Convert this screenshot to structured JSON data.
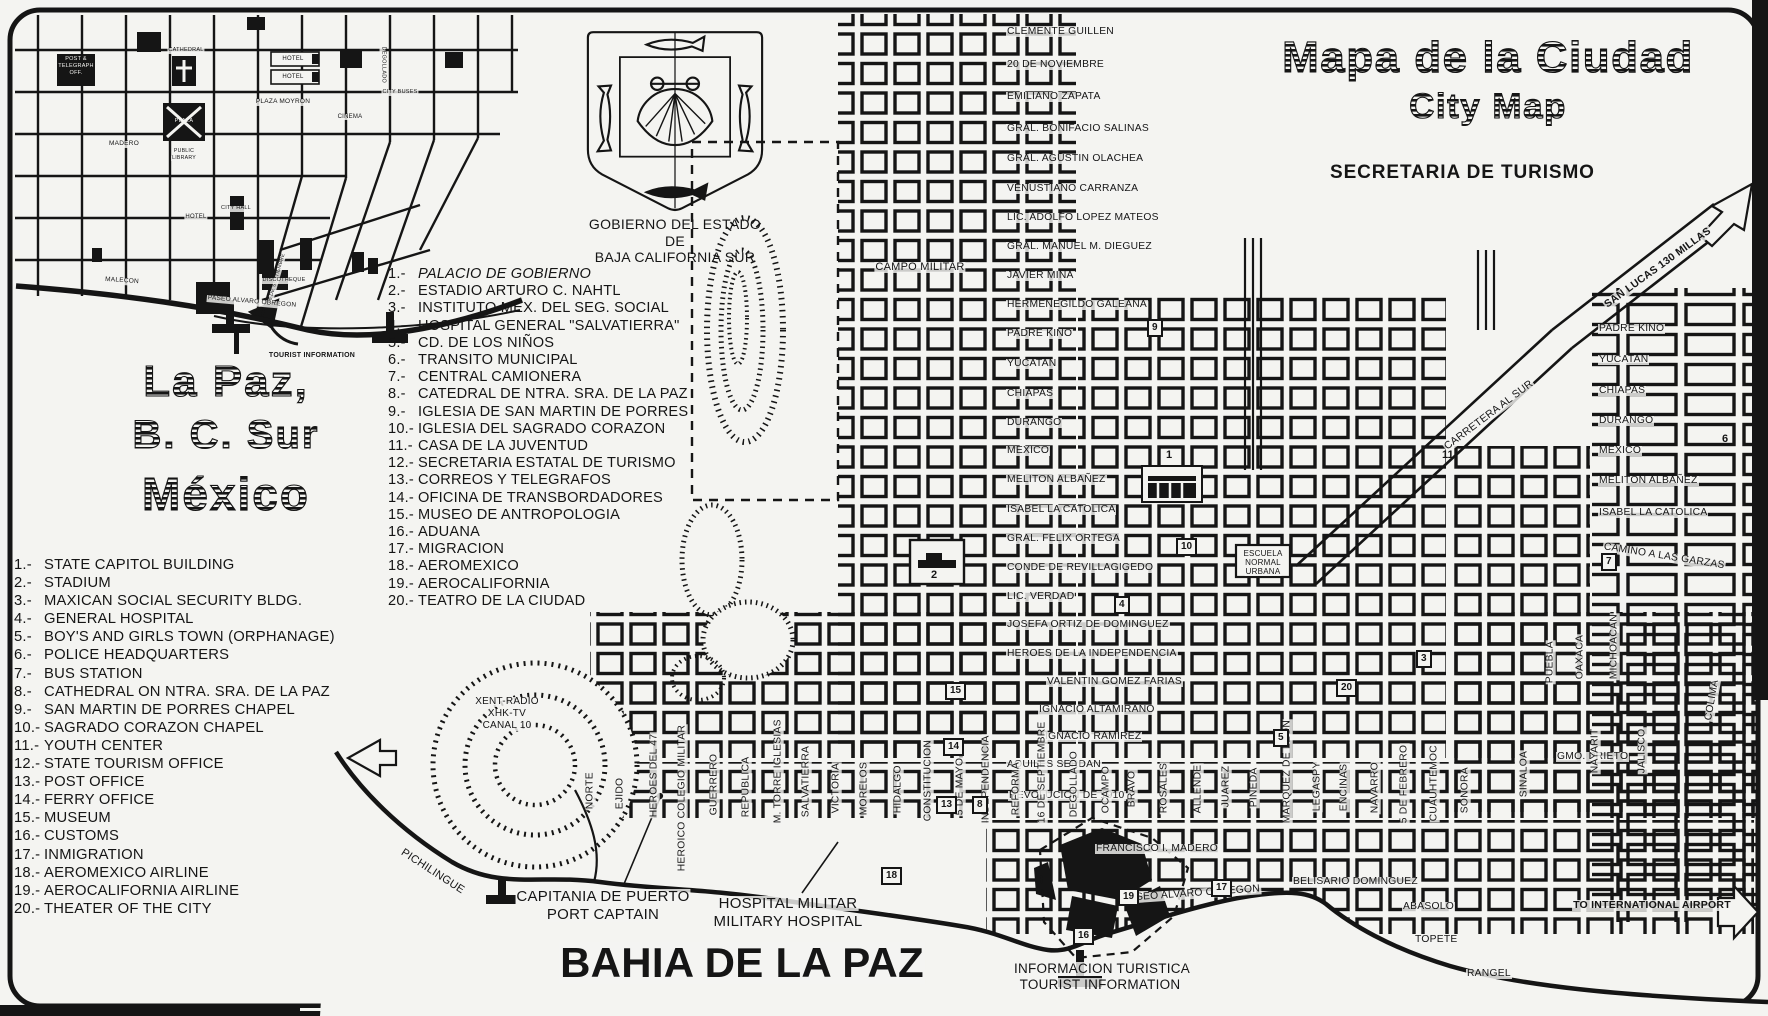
{
  "header": {
    "title_es": "Mapa de la Ciudad",
    "title_en": "City Map",
    "org": "SECRETARIA DE TURISMO"
  },
  "place": {
    "l1": "La Paz,",
    "l2": "B. C. Sur",
    "l3": "México"
  },
  "crest": {
    "c1": "GOBIERNO DEL ESTADO",
    "c2": "DE",
    "c3": "BAJA CALIFORNIA SUR"
  },
  "legend_es": {
    "items": [
      "PALACIO DE GOBIERNO",
      "ESTADIO ARTURO C. NAHTL",
      "INSTITUTO MEX. DEL SEG. SOCIAL",
      "HOSPITAL GENERAL \"SALVATIERRA\"",
      "CD. DE LOS NIÑOS",
      "TRANSITO MUNICIPAL",
      "CENTRAL CAMIONERA",
      "CATEDRAL DE NTRA. SRA. DE LA PAZ",
      "IGLESIA DE SAN MARTIN DE PORRES",
      "IGLESIA DEL SAGRADO CORAZON",
      "CASA DE LA JUVENTUD",
      "SECRETARIA ESTATAL DE TURISMO",
      "CORREOS Y TELEGRAFOS",
      "OFICINA DE TRANSBORDADORES",
      "MUSEO DE ANTROPOLOGIA",
      "ADUANA",
      "MIGRACION",
      "AEROMEXICO",
      "AEROCALIFORNIA",
      "TEATRO DE LA CIUDAD"
    ]
  },
  "legend_en": {
    "items": [
      "STATE CAPITOL BUILDING",
      "STADIUM",
      "MAXICAN SOCIAL SECURITY BLDG.",
      "GENERAL HOSPITAL",
      "BOY'S AND GIRLS TOWN (ORPHANAGE)",
      "POLICE HEADQUARTERS",
      "BUS STATION",
      "CATHEDRAL ON NTRA. SRA. DE LA PAZ",
      "SAN MARTIN DE PORRES CHAPEL",
      "SAGRADO CORAZON CHAPEL",
      "YOUTH CENTER",
      "STATE TOURISM OFFICE",
      "POST OFFICE",
      "FERRY OFFICE",
      "MUSEUM",
      "CUSTOMS",
      "INMIGRATION",
      "AEROMEXICO AIRLINE",
      "AEROCALIFORNIA AIRLINE",
      "THEATER OF THE CITY"
    ]
  },
  "inset": {
    "labels": [
      {
        "t": "POST &",
        "x": 76,
        "y": 57,
        "s": 5.5,
        "c": 1,
        "inv": 1
      },
      {
        "t": "TELEGRAPH",
        "x": 76,
        "y": 64,
        "s": 5.5,
        "c": 1,
        "inv": 1
      },
      {
        "t": "OFF.",
        "x": 76,
        "y": 71,
        "s": 5.5,
        "c": 1,
        "inv": 1
      },
      {
        "t": "CATHEDRAL",
        "x": 186,
        "y": 48,
        "s": 5.5,
        "c": 1
      },
      {
        "t": "HOTEL",
        "x": 293,
        "y": 56,
        "s": 6,
        "c": 1
      },
      {
        "t": "HOTEL",
        "x": 293,
        "y": 74,
        "s": 6,
        "c": 1
      },
      {
        "t": "PLAZA MOYRON",
        "x": 283,
        "y": 99,
        "s": 6.5,
        "c": 1
      },
      {
        "t": "CINEMA",
        "x": 350,
        "y": 114,
        "s": 6,
        "c": 1
      },
      {
        "t": "PLAZA",
        "x": 184,
        "y": 119,
        "s": 5.5,
        "c": 1,
        "inv": 1
      },
      {
        "t": "MADERO",
        "x": 124,
        "y": 141,
        "s": 6.5,
        "c": 1
      },
      {
        "t": "PUBLIC",
        "x": 184,
        "y": 149,
        "s": 5.2,
        "c": 1
      },
      {
        "t": "LIBRARY",
        "x": 184,
        "y": 156,
        "s": 5.2,
        "c": 1
      },
      {
        "t": "CITY HALL",
        "x": 236,
        "y": 206,
        "s": 5.5,
        "c": 1
      },
      {
        "t": "HOTEL",
        "x": 196,
        "y": 214,
        "s": 6,
        "c": 1
      },
      {
        "t": "DEGOLLADO",
        "x": 380,
        "y": 40,
        "s": 5.5,
        "r": 90
      },
      {
        "t": "CITY BUSES",
        "x": 400,
        "y": 90,
        "s": 5.5,
        "c": 1
      },
      {
        "t": "16 DE SEPTIEMBRE",
        "x": 272,
        "y": 300,
        "s": 5,
        "r": -74
      },
      {
        "t": "DISCOTHEQUE",
        "x": 284,
        "y": 278,
        "s": 5.5,
        "c": 1
      },
      {
        "t": "MALECON",
        "x": 122,
        "y": 278,
        "s": 6.5,
        "c": 1,
        "r": 4
      },
      {
        "t": "PASEO ALVARO OBREGON",
        "x": 252,
        "y": 299,
        "s": 6.5,
        "c": 1,
        "r": 5
      },
      {
        "t": "TOURIST INFORMATION",
        "x": 312,
        "y": 352,
        "s": 7,
        "c": 1,
        "w": 700
      }
    ]
  },
  "map": {
    "street_labels": [
      {
        "t": "CLEMENTE GUILLEN",
        "x": 1006,
        "y": 27
      },
      {
        "t": "20 DE NOVIEMBRE",
        "x": 1006,
        "y": 60
      },
      {
        "t": "EMILIANO ZAPATA",
        "x": 1006,
        "y": 92
      },
      {
        "t": "GRAL. BONIFACIO SALINAS",
        "x": 1006,
        "y": 124
      },
      {
        "t": "GRAL. AGUSTIN OLACHEA",
        "x": 1006,
        "y": 154
      },
      {
        "t": "VENUSTIANO CARRANZA",
        "x": 1006,
        "y": 184
      },
      {
        "t": "LIC. ADOLFO LOPEZ MATEOS",
        "x": 1006,
        "y": 213
      },
      {
        "t": "GRAL. MANUEL M. DIEGUEZ",
        "x": 1006,
        "y": 242
      },
      {
        "t": "JAVIER MINA",
        "x": 1006,
        "y": 271
      },
      {
        "t": "HERMENEGILDO GALEANA",
        "x": 1006,
        "y": 300
      },
      {
        "t": "PADRE KINO",
        "x": 1006,
        "y": 329
      },
      {
        "t": "YUCATAN",
        "x": 1006,
        "y": 359
      },
      {
        "t": "CHIAPAS",
        "x": 1006,
        "y": 389
      },
      {
        "t": "DURANGO",
        "x": 1006,
        "y": 418
      },
      {
        "t": "MEXICO",
        "x": 1006,
        "y": 446
      },
      {
        "t": "MELITON ALBAÑEZ",
        "x": 1006,
        "y": 475
      },
      {
        "t": "ISABEL LA CATOLICA",
        "x": 1006,
        "y": 505
      },
      {
        "t": "GRAL. FELIX ORTEGA",
        "x": 1006,
        "y": 534
      },
      {
        "t": "CONDE DE REVILLAGIGEDO",
        "x": 1006,
        "y": 563
      },
      {
        "t": "LIC. VERDAD",
        "x": 1006,
        "y": 592
      },
      {
        "t": "JOSEFA ORTIZ DE DOMINGUEZ",
        "x": 1006,
        "y": 620
      },
      {
        "t": "HEROES DE LA INDEPENDENCIA",
        "x": 1006,
        "y": 649
      },
      {
        "t": "VALENTIN GOMEZ FARIAS",
        "x": 1046,
        "y": 677
      },
      {
        "t": "IGNACIO ALTAMIRANO",
        "x": 1038,
        "y": 705
      },
      {
        "t": "IGNACIO RAMIREZ",
        "x": 1044,
        "y": 732
      },
      {
        "t": "AQUILES SERDAN",
        "x": 1006,
        "y": 760
      },
      {
        "t": "REVOLUCION DE 1910",
        "x": 1008,
        "y": 791
      },
      {
        "t": "FRANCISCO I. MADERO",
        "x": 1095,
        "y": 844
      },
      {
        "t": "BELISARIO DOMINGUEZ",
        "x": 1292,
        "y": 877
      },
      {
        "t": "PASEO ALVARO OBREGON",
        "x": 1122,
        "y": 894,
        "r": -4
      },
      {
        "t": "ABASOLO",
        "x": 1402,
        "y": 902
      },
      {
        "t": "TOPETE",
        "x": 1414,
        "y": 935
      },
      {
        "t": "RANGEL",
        "x": 1466,
        "y": 969
      },
      {
        "t": "GMO. PRIETO",
        "x": 1556,
        "y": 752
      },
      {
        "t": "PADRE KINO",
        "x": 1598,
        "y": 324
      },
      {
        "t": "YUCATAN",
        "x": 1598,
        "y": 355
      },
      {
        "t": "CHIAPAS",
        "x": 1598,
        "y": 386
      },
      {
        "t": "DURANGO",
        "x": 1598,
        "y": 416
      },
      {
        "t": "MEXICO",
        "x": 1598,
        "y": 446
      },
      {
        "t": "MELITON ALBAÑEZ",
        "x": 1598,
        "y": 476
      },
      {
        "t": "ISABEL LA CATOLICA",
        "x": 1598,
        "y": 508
      },
      {
        "t": "CAMINO A LAS GARZAS",
        "x": 1602,
        "y": 542,
        "r": 9
      },
      {
        "t": "SAN LUCAS 130 MILLAS",
        "x": 1608,
        "y": 300,
        "r": -36,
        "s": 10.5,
        "w": 700
      },
      {
        "t": "CARRETERA AL SUR",
        "x": 1448,
        "y": 442,
        "r": -37,
        "s": 10.5
      },
      {
        "t": "NORTE",
        "x": 596,
        "y": 800,
        "r": -90
      },
      {
        "t": "EJIDO",
        "x": 626,
        "y": 800,
        "r": -90
      },
      {
        "t": "HEROES DEL 47",
        "x": 660,
        "y": 808,
        "r": -90
      },
      {
        "t": "HEROICO COLEGIO MILITAR",
        "x": 688,
        "y": 862,
        "r": -90
      },
      {
        "t": "GUERRERO",
        "x": 720,
        "y": 806,
        "r": -90
      },
      {
        "t": "REPUBLICA",
        "x": 752,
        "y": 808,
        "r": -90
      },
      {
        "t": "M. TORRE IGLESIAS",
        "x": 784,
        "y": 814,
        "r": -90
      },
      {
        "t": "SALVATIERRA",
        "x": 812,
        "y": 808,
        "r": -90
      },
      {
        "t": "VICTORIA",
        "x": 842,
        "y": 804,
        "r": -90
      },
      {
        "t": "MORELOS",
        "x": 870,
        "y": 806,
        "r": -90
      },
      {
        "t": "HIDALGO",
        "x": 904,
        "y": 804,
        "r": -90
      },
      {
        "t": "CONSTITUCION",
        "x": 934,
        "y": 812,
        "r": -90
      },
      {
        "t": "5 DE MAYO",
        "x": 966,
        "y": 806,
        "r": -90
      },
      {
        "t": "INDEPENDENCIA",
        "x": 992,
        "y": 814,
        "r": -90
      },
      {
        "t": "REFORMA",
        "x": 1022,
        "y": 806,
        "r": -90
      },
      {
        "t": "16 DE SEPTIEMBRE",
        "x": 1048,
        "y": 814,
        "r": -90
      },
      {
        "t": "DEGOLLADO",
        "x": 1080,
        "y": 808,
        "r": -90
      },
      {
        "t": "OCAMPO",
        "x": 1112,
        "y": 804,
        "r": -90
      },
      {
        "t": "BRAVO",
        "x": 1138,
        "y": 798,
        "r": -90
      },
      {
        "t": "ROSALES",
        "x": 1170,
        "y": 804,
        "r": -90
      },
      {
        "t": "ALLENDE",
        "x": 1204,
        "y": 804,
        "r": -90
      },
      {
        "t": "JUAREZ",
        "x": 1232,
        "y": 798,
        "r": -90
      },
      {
        "t": "PINEDA",
        "x": 1260,
        "y": 798,
        "r": -90
      },
      {
        "t": "MARQUEZ DE LEON",
        "x": 1293,
        "y": 814,
        "r": -90
      },
      {
        "t": "LEGASPY",
        "x": 1323,
        "y": 802,
        "r": -90
      },
      {
        "t": "ENCINAS",
        "x": 1350,
        "y": 802,
        "r": -90
      },
      {
        "t": "NAVARRO",
        "x": 1381,
        "y": 804,
        "r": -90
      },
      {
        "t": "5 DE FEBRERO",
        "x": 1410,
        "y": 814,
        "r": -90
      },
      {
        "t": "CUAUHTEMOC",
        "x": 1440,
        "y": 812,
        "r": -90
      },
      {
        "t": "SONORA",
        "x": 1471,
        "y": 804,
        "r": -90
      },
      {
        "t": "SINALOA",
        "x": 1530,
        "y": 788,
        "r": -90
      },
      {
        "t": "NAYARIT",
        "x": 1601,
        "y": 764,
        "r": -90
      },
      {
        "t": "JALISCO",
        "x": 1648,
        "y": 764,
        "r": -90
      },
      {
        "t": "COLIMA",
        "x": 1714,
        "y": 712,
        "r": -80
      },
      {
        "t": "PUEBLA",
        "x": 1556,
        "y": 674,
        "r": -90
      },
      {
        "t": "OAXACA",
        "x": 1586,
        "y": 670,
        "r": -90
      },
      {
        "t": "MICHOACAN",
        "x": 1620,
        "y": 670,
        "r": -90
      }
    ],
    "area_labels": [
      {
        "t": "XENT-RADIO",
        "x": 507,
        "y": 697,
        "s": 10,
        "c": 1,
        "n": "radio-station-label"
      },
      {
        "t": "XHK-TV",
        "x": 507,
        "y": 709,
        "s": 10,
        "c": 1,
        "n": "radio-station-label"
      },
      {
        "t": "CANAL 10",
        "x": 507,
        "y": 721,
        "s": 10,
        "c": 1,
        "n": "radio-station-label"
      },
      {
        "t": "PICHILINGUE",
        "x": 398,
        "y": 845,
        "r": 33,
        "s": 11,
        "n": "road-label"
      },
      {
        "t": "CAMPO MILITAR",
        "x": 920,
        "y": 262,
        "s": 11,
        "c": 1,
        "n": "military-camp-label"
      },
      {
        "t": "CAPITANIA DE PUERTO",
        "x": 603,
        "y": 889,
        "s": 15,
        "c": 1,
        "n": "port-captain-label"
      },
      {
        "t": "PORT CAPTAIN",
        "x": 603,
        "y": 907,
        "s": 15,
        "c": 1,
        "n": "port-captain-label"
      },
      {
        "t": "HOSPITAL MILITAR",
        "x": 788,
        "y": 896,
        "s": 15,
        "c": 1,
        "n": "military-hospital-label"
      },
      {
        "t": "MILITARY HOSPITAL",
        "x": 788,
        "y": 914,
        "s": 15,
        "c": 1,
        "n": "military-hospital-label"
      },
      {
        "t": "BAHIA DE LA PAZ",
        "x": 742,
        "y": 942,
        "s": 42,
        "c": 1,
        "w": 900,
        "n": "bay-label"
      },
      {
        "t": "INFORMACION TURISTICA",
        "x": 1102,
        "y": 962,
        "s": 13.5,
        "c": 1,
        "n": "tourist-info-label"
      },
      {
        "t": "TOURIST INFORMATION",
        "x": 1100,
        "y": 978,
        "s": 13.5,
        "c": 1,
        "n": "tourist-info-label"
      },
      {
        "t": "TO INTERNATIONAL AIRPORT",
        "x": 1652,
        "y": 900,
        "s": 10.5,
        "c": 1,
        "w": 700,
        "n": "airport-label"
      },
      {
        "t": "ESCUELA",
        "x": 1263,
        "y": 550,
        "s": 8,
        "c": 1,
        "n": "school-label"
      },
      {
        "t": "NORMAL",
        "x": 1263,
        "y": 559,
        "s": 8,
        "c": 1,
        "n": "school-label"
      },
      {
        "t": "URBANA",
        "x": 1263,
        "y": 568,
        "s": 8,
        "c": 1,
        "n": "school-label"
      }
    ],
    "markers": [
      {
        "n": "1",
        "x": 1166,
        "y": 450,
        "b": false
      },
      {
        "n": "2",
        "x": 931,
        "y": 570,
        "b": false
      },
      {
        "n": "3",
        "x": 1416,
        "y": 650,
        "b": true
      },
      {
        "n": "4",
        "x": 1114,
        "y": 596,
        "b": true
      },
      {
        "n": "5",
        "x": 1273,
        "y": 729,
        "b": true
      },
      {
        "n": "6",
        "x": 1722,
        "y": 434,
        "b": false
      },
      {
        "n": "7",
        "x": 1601,
        "y": 553,
        "b": true
      },
      {
        "n": "8",
        "x": 972,
        "y": 796,
        "b": true
      },
      {
        "n": "9",
        "x": 1147,
        "y": 319,
        "b": true
      },
      {
        "n": "10",
        "x": 1176,
        "y": 538,
        "b": true
      },
      {
        "n": "11",
        "x": 1442,
        "y": 450,
        "b": false
      },
      {
        "n": "13",
        "x": 936,
        "y": 796,
        "b": true
      },
      {
        "n": "14",
        "x": 943,
        "y": 738,
        "b": true
      },
      {
        "n": "15",
        "x": 945,
        "y": 682,
        "b": true
      },
      {
        "n": "16",
        "x": 1073,
        "y": 927,
        "b": true
      },
      {
        "n": "17",
        "x": 1211,
        "y": 879,
        "b": true
      },
      {
        "n": "18",
        "x": 881,
        "y": 867,
        "b": true
      },
      {
        "n": "19",
        "x": 1118,
        "y": 888,
        "b": true
      },
      {
        "n": "20",
        "x": 1336,
        "y": 679,
        "b": true
      }
    ]
  }
}
